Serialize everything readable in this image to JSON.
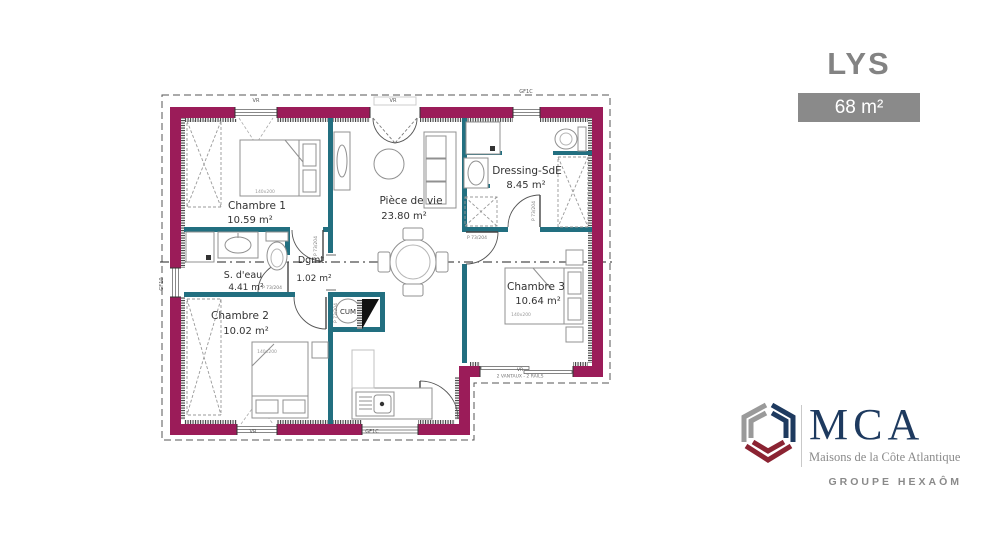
{
  "header": {
    "title": "LYS",
    "area_badge": "68 m²"
  },
  "plan": {
    "rooms": [
      {
        "name": "Chambre 1",
        "area": "10.59 m²"
      },
      {
        "name": "Pièce de vie",
        "area": "23.80 m²"
      },
      {
        "name": "Dressing-SdE",
        "area": "8.45 m²"
      },
      {
        "name": "S. d'eau",
        "area": "4.41 m²"
      },
      {
        "name": "Dgmt",
        "area": "1.02 m²"
      },
      {
        "name": "Chambre 2",
        "area": "10.02 m²"
      },
      {
        "name": "Chambre 3",
        "area": "10.64 m²"
      }
    ],
    "annotations": {
      "bed_size": "140x200",
      "water_heater": "CUM",
      "door_label": "P 73/204",
      "window_vr": "VR",
      "window_gf10": "GF10",
      "window_gf1c": "GF1C",
      "bay_label": "2 VANTAUX - 2 RAILS"
    },
    "colors": {
      "exterior_wall": "#9B1C59",
      "interior_wall": "#226F80"
    }
  },
  "logo": {
    "brand": "MCA",
    "tagline": "Maisons de la Côte Atlantique",
    "group": "GROUPE HEXAÔM",
    "navy": "#1E3A5F",
    "gray": "#9A9A9A",
    "red": "#8B2332"
  }
}
